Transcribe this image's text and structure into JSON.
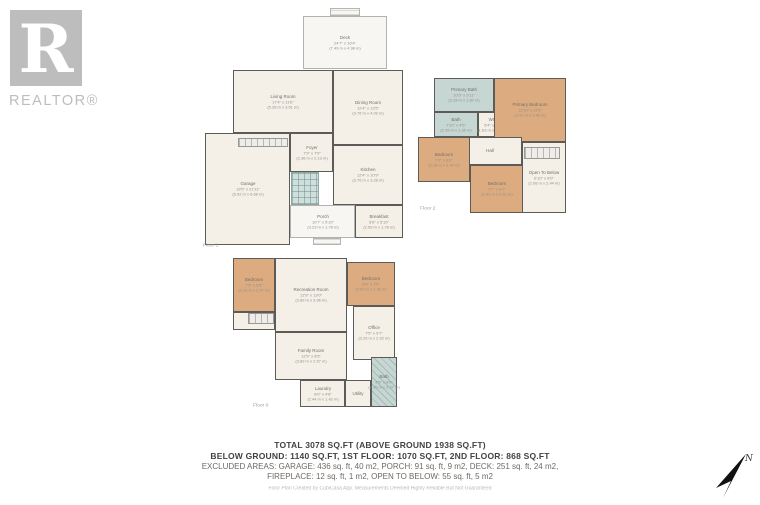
{
  "logo": {
    "initial": "R",
    "wordmark": "REALTOR®"
  },
  "compass": {
    "label": "N"
  },
  "summary": {
    "line1": "TOTAL 3078 SQ.FT (ABOVE GROUND 1938 SQ.FT)",
    "line2": "BELOW GROUND: 1140 SQ.FT, 1ST FLOOR: 1070 SQ.FT, 2ND FLOOR: 868 SQ.FT",
    "line3": "EXCLUDED AREAS: GARAGE: 436 sq. ft, 40 m2, PORCH: 91 sq. ft, 9 m2, DECK: 251 sq. ft, 24 m2,",
    "line4": "FIREPLACE: 12 sq. ft, 1 m2, OPEN TO BELOW: 55 sq. ft, 5 m2",
    "credit": "Floor Plan Created by CubiCasa App. Measurements Deemed Highly Reliable But Not Guaranteed"
  },
  "colors": {
    "wall": "#5d5b58",
    "floor": "#f4f0e8",
    "bedroom": "#dcab80",
    "bath": "#c6d6d2",
    "outdoor": "#f7f6f3",
    "logo_gray": "#bdbdbd",
    "arrow_black": "#111111"
  },
  "floors": [
    {
      "id": "floor-1",
      "label": "Floor 1",
      "origin": [
        195,
        8
      ],
      "size": [
        215,
        242
      ],
      "label_pos": [
        8,
        234
      ],
      "rooms": [
        {
          "name": "Deck",
          "ft": "24'7\" x 16'4\"",
          "m": "(7.49 m x 4.98 m)",
          "type": "outdoor",
          "box": [
            108,
            8,
            84,
            53
          ]
        },
        {
          "name": "Living Room",
          "ft": "17'4\" x 11'6\"",
          "m": "(5.28 m x 3.51 m)",
          "type": "std",
          "box": [
            38,
            62,
            100,
            63
          ]
        },
        {
          "name": "Dining Room",
          "ft": "12'4\" x 13'5\"",
          "m": "(3.76 m x 4.09 m)",
          "type": "std",
          "box": [
            138,
            62,
            70,
            75
          ]
        },
        {
          "name": "Garage",
          "ft": "19'5\" x 21'11\"",
          "m": "(5.92 m x 6.68 m)",
          "type": "std",
          "box": [
            10,
            125,
            85,
            112
          ]
        },
        {
          "name": "Foyer",
          "ft": "7'9\" x 7'0\"",
          "m": "(2.36 m x 2.13 m)",
          "type": "std",
          "box": [
            95,
            125,
            43,
            39
          ]
        },
        {
          "name": "Kitchen",
          "ft": "12'4\" x 10'9\"",
          "m": "(3.76 m x 3.28 m)",
          "type": "std",
          "box": [
            138,
            137,
            70,
            60
          ]
        },
        {
          "name": "Breakfast",
          "ft": "8'6\" x 5'10\"",
          "m": "(2.59 m x 1.78 m)",
          "type": "std",
          "box": [
            160,
            197,
            48,
            33
          ]
        },
        {
          "name": "Porch",
          "ft": "10'7\" x 5'10\"",
          "m": "(3.23 m x 1.78 m)",
          "type": "outdoor",
          "box": [
            95,
            197,
            65,
            33
          ]
        }
      ],
      "features": [
        {
          "type": "steps",
          "box": [
            135,
            0,
            30,
            8
          ]
        },
        {
          "type": "stairs",
          "box": [
            43,
            130,
            50,
            9
          ]
        },
        {
          "type": "stairs-teal",
          "box": [
            96,
            164,
            28,
            33
          ]
        },
        {
          "type": "steps",
          "box": [
            118,
            230,
            28,
            7
          ]
        }
      ]
    },
    {
      "id": "floor-2",
      "label": "Floor 2",
      "origin": [
        418,
        73
      ],
      "size": [
        150,
        142
      ],
      "label_pos": [
        2,
        132
      ],
      "rooms": [
        {
          "name": "Primary Bath",
          "ft": "10'9\" x 5'11\"",
          "m": "(3.28 m x 1.80 m)",
          "type": "bath",
          "box": [
            16,
            5,
            60,
            34
          ]
        },
        {
          "name": "Bath",
          "ft": "7'10\" x 4'5\"",
          "m": "(2.39 m x 1.35 m)",
          "type": "bath",
          "box": [
            16,
            39,
            44,
            25
          ]
        },
        {
          "name": "WIC",
          "ft": "5'4\" x 4'5\"",
          "m": "(1.63 m x 1.35 m)",
          "type": "std",
          "box": [
            60,
            39,
            30,
            25
          ]
        },
        {
          "name": "Primary Bedroom",
          "ft": "12'10\" x 11'5\"",
          "m": "(3.91 m x 3.48 m)",
          "type": "bedroom",
          "box": [
            76,
            5,
            72,
            64
          ]
        },
        {
          "name": "Hall",
          "ft": "",
          "m": "",
          "type": "std",
          "box": [
            40,
            64,
            64,
            28
          ]
        },
        {
          "name": "Bedroom",
          "ft": "7'2\" x 8'0\"",
          "m": "(2.18 m x 2.44 m)",
          "type": "bedroom",
          "box": [
            0,
            64,
            52,
            45
          ]
        },
        {
          "name": "Bedroom",
          "ft": "9'7\" x 8'7\"",
          "m": "(2.92 m x 2.62 m)",
          "type": "bedroom",
          "box": [
            52,
            92,
            54,
            48
          ]
        },
        {
          "name": "Open To Below",
          "ft": "6'10\" x 8'0\"",
          "m": "(2.08 m x 2.44 m)",
          "type": "std",
          "box": [
            104,
            69,
            44,
            71
          ]
        }
      ],
      "features": [
        {
          "type": "stairs",
          "box": [
            106,
            74,
            36,
            12
          ]
        }
      ]
    },
    {
      "id": "floor-0",
      "label": "Floor 0",
      "origin": [
        228,
        252
      ],
      "size": [
        172,
        160
      ],
      "label_pos": [
        25,
        150
      ],
      "rooms": [
        {
          "name": "Bedroom",
          "ft": "7'5\" x 9'5\"",
          "m": "(2.26 m x 2.87 m)",
          "type": "bedroom",
          "box": [
            5,
            6,
            42,
            54
          ]
        },
        {
          "name": "Recreation Room",
          "ft": "12'9\" x 13'0\"",
          "m": "(3.89 m x 3.96 m)",
          "type": "std",
          "box": [
            47,
            6,
            72,
            74
          ]
        },
        {
          "name": "Bedroom",
          "ft": "8'6\" x 7'9\"",
          "m": "(2.59 m x 2.36 m)",
          "type": "bedroom",
          "box": [
            119,
            10,
            48,
            44
          ]
        },
        {
          "name": "Office",
          "ft": "7'5\" x 9'7\"",
          "m": "(2.26 m x 2.92 m)",
          "type": "std",
          "box": [
            125,
            54,
            42,
            54
          ]
        },
        {
          "name": "Family Room",
          "ft": "12'9\" x 8'5\"",
          "m": "(3.89 m x 2.57 m)",
          "type": "std",
          "box": [
            47,
            80,
            72,
            48
          ]
        },
        {
          "name": "Hall",
          "ft": "",
          "m": "",
          "type": "std",
          "box": [
            5,
            60,
            42,
            18
          ]
        },
        {
          "name": "Laundry",
          "ft": "8'0\" x 4'8\"",
          "m": "(2.44 m x 1.42 m)",
          "type": "std",
          "box": [
            72,
            128,
            45,
            27
          ]
        },
        {
          "name": "Utility",
          "ft": "",
          "m": "",
          "type": "std",
          "box": [
            117,
            128,
            26,
            27
          ]
        },
        {
          "name": "Bath",
          "ft": "4'5\" x 8'9\"",
          "m": "(1.35 m x 2.67 m)",
          "type": "bath hatch",
          "box": [
            143,
            105,
            26,
            50
          ]
        }
      ],
      "features": [
        {
          "type": "stairs",
          "box": [
            20,
            61,
            26,
            11
          ]
        }
      ]
    }
  ]
}
